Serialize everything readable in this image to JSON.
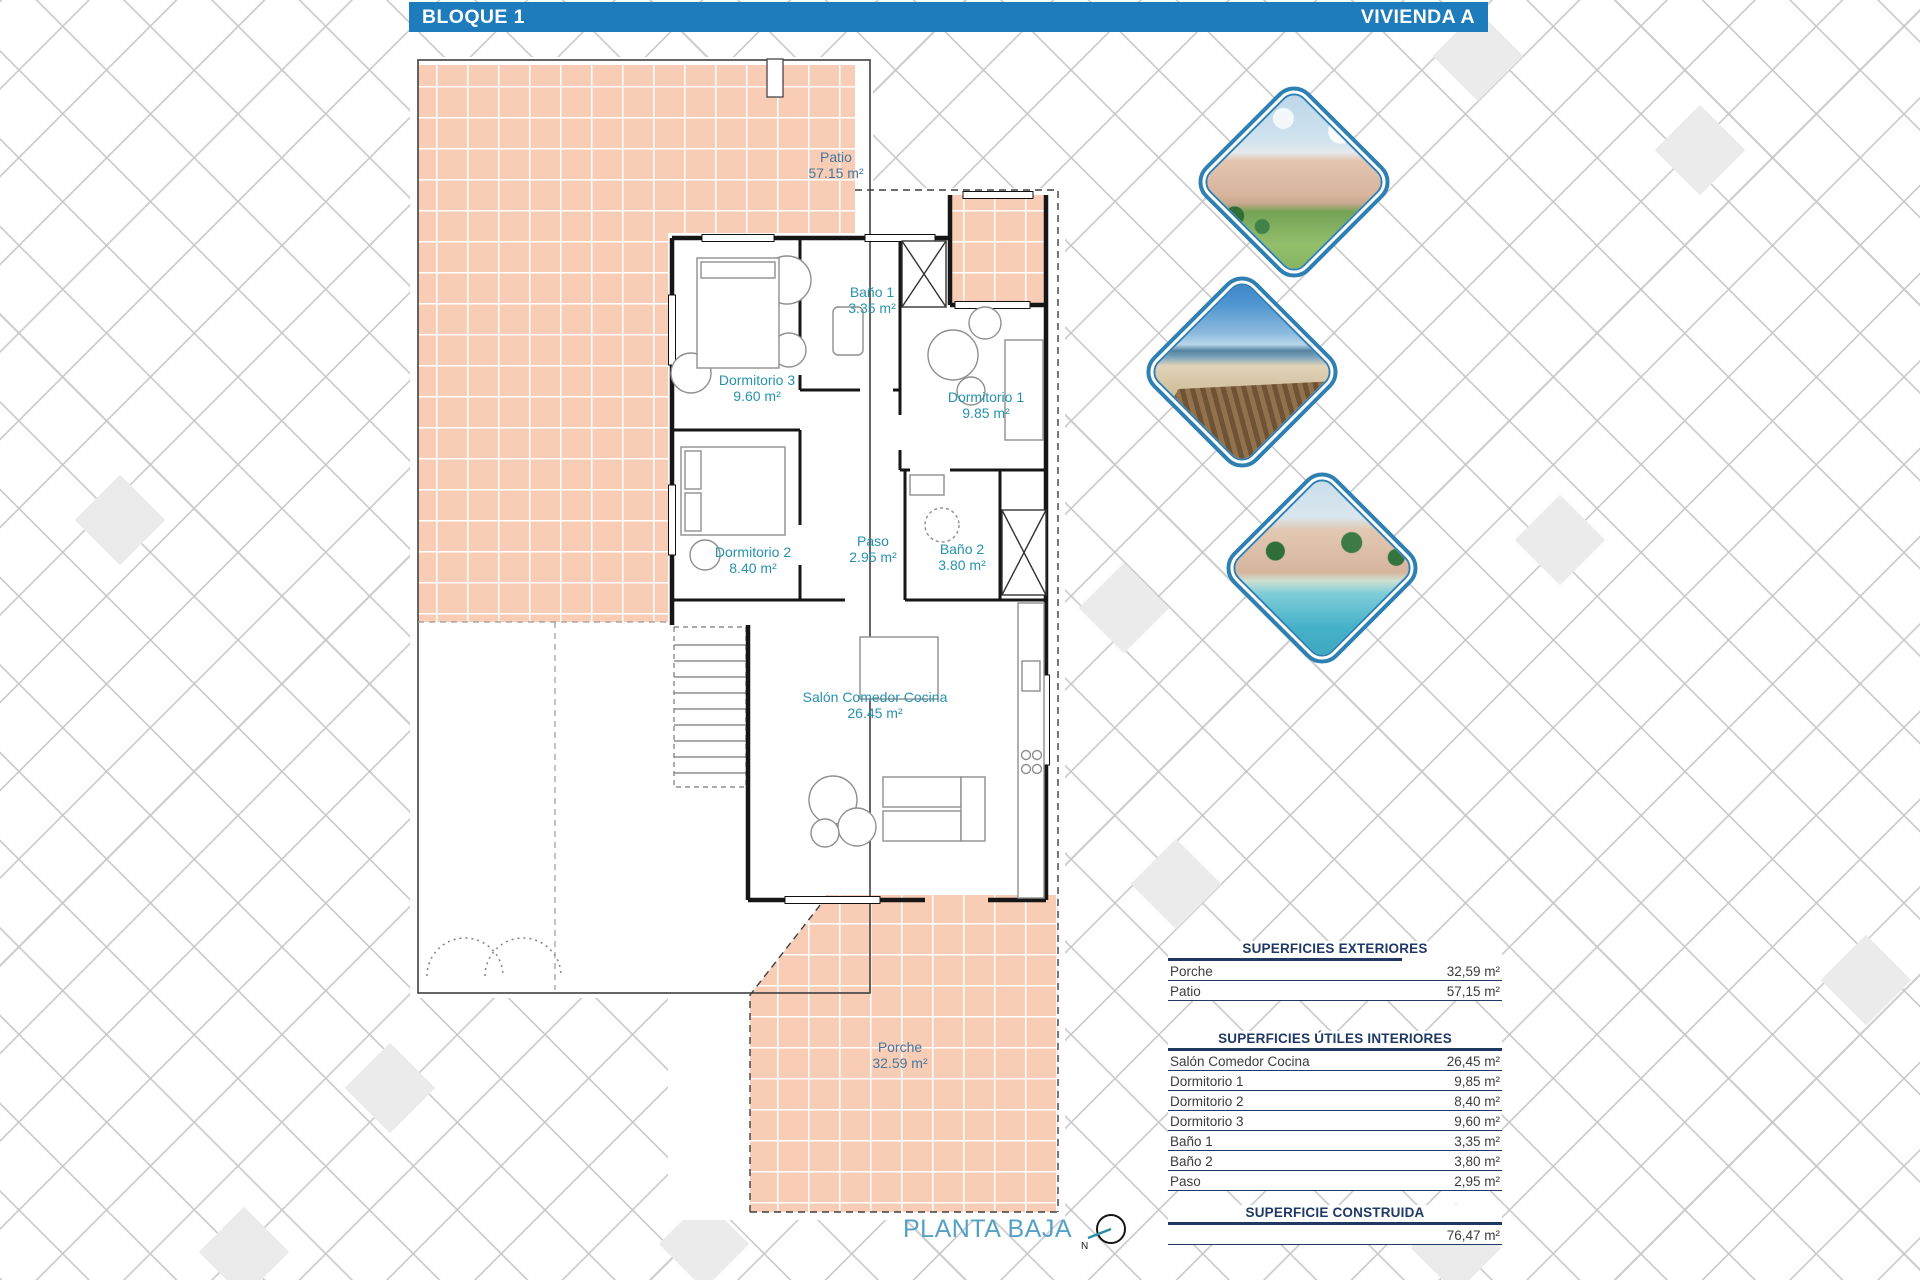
{
  "header": {
    "left_title": "BLOQUE 1",
    "right_title": "VIVIENDA A"
  },
  "floor_plan": {
    "outdoor_areas": [
      {
        "name": "Patio",
        "area": "57.15 m²"
      },
      {
        "name": "Porche",
        "area": "32.59 m²"
      }
    ],
    "rooms": [
      {
        "name": "Dormitorio 3",
        "area": "9.60 m²"
      },
      {
        "name": "Baño 1",
        "area": "3.35 m²"
      },
      {
        "name": "Dormitorio 1",
        "area": "9.85 m²"
      },
      {
        "name": "Dormitorio 2",
        "area": "8.40 m²"
      },
      {
        "name": "Paso",
        "area": "2.95 m²"
      },
      {
        "name": "Baño 2",
        "area": "3.80 m²"
      },
      {
        "name": "Salón Comedor Cocina",
        "area": "26.45 m²"
      }
    ],
    "caption": "PLANTA BAJA",
    "compass_north": "N"
  },
  "surface_tables": [
    {
      "title": "SUPERFICIES EXTERIORES",
      "rows": [
        {
          "label": "Porche",
          "value": "32,59 m²"
        },
        {
          "label": "Patio",
          "value": "57,15 m²"
        }
      ]
    },
    {
      "title": "SUPERFICIES ÚTILES INTERIORES",
      "rows": [
        {
          "label": "Salón Comedor Cocina",
          "value": "26,45 m²"
        },
        {
          "label": "Dormitorio 1",
          "value": "9,85 m²"
        },
        {
          "label": "Dormitorio 2",
          "value": "8,40 m²"
        },
        {
          "label": "Dormitorio 3",
          "value": "9,60 m²"
        },
        {
          "label": "Baño 1",
          "value": "3,35 m²"
        },
        {
          "label": "Baño 2",
          "value": "3,80 m²"
        },
        {
          "label": "Paso",
          "value": "2,95 m²"
        }
      ]
    },
    {
      "title": "SUPERFICIE CONSTRUIDA",
      "rows": [
        {
          "label": "",
          "value": "76,47 m²"
        }
      ]
    }
  ],
  "photos": [
    {
      "description": "apartment complex with gardens"
    },
    {
      "description": "beach boardwalk"
    },
    {
      "description": "apartments with swimming pool"
    }
  ],
  "colors": {
    "header_bar": "#1e7cbd",
    "tile_fill": "#f9ccb6",
    "room_label": "#2792ad",
    "outdoor_label": "#45789c",
    "table_navy": "#1f3864",
    "caption_blue": "#55a1c6",
    "photo_frame_blue": "#2f80b2"
  }
}
